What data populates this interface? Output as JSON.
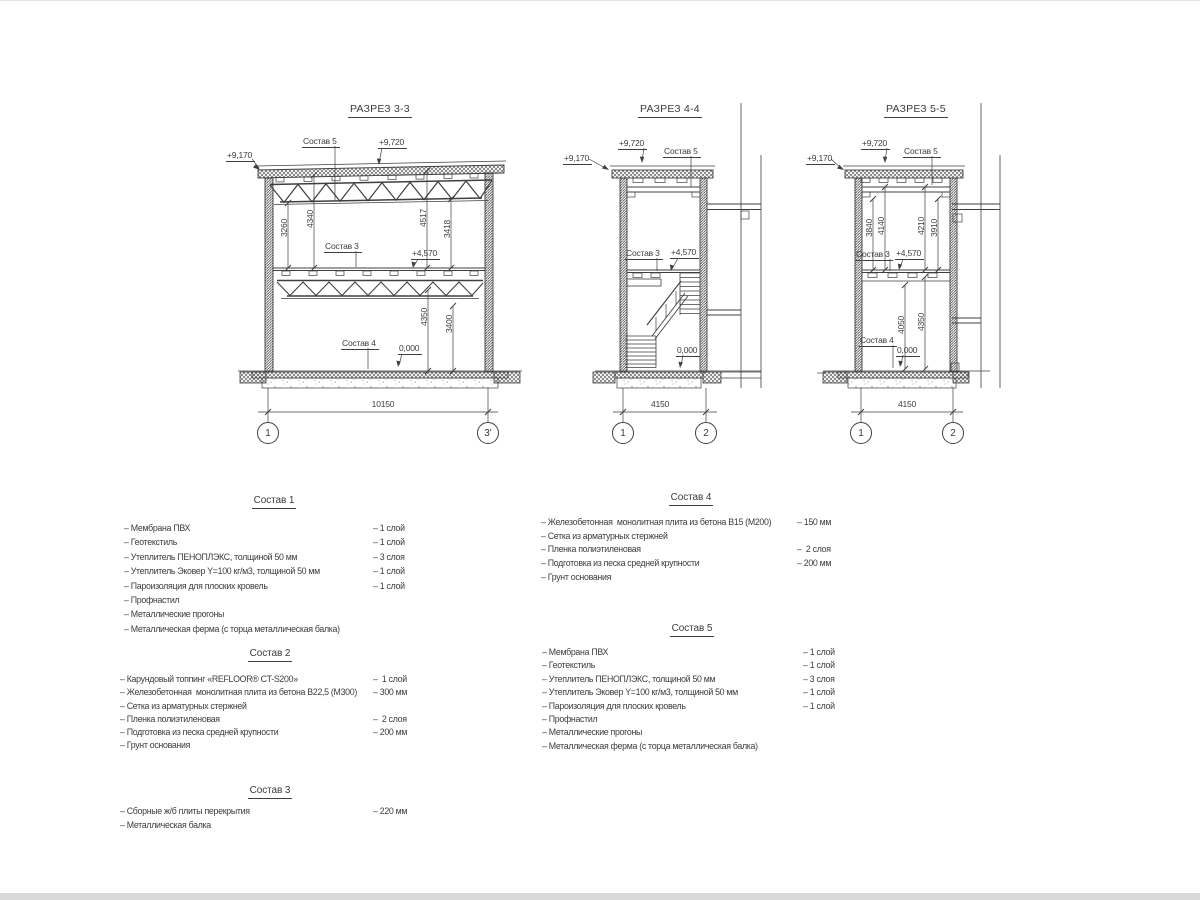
{
  "page": {
    "background": "#ffffff",
    "edge_bar_color": "#d9d9d9",
    "line_color": "#3f3f3f"
  },
  "sections": [
    {
      "title": "РАЗРЕЗ 3-3",
      "labels": {
        "roof": "Состав 5",
        "floor": "Состав 3",
        "ground": "Состав 4"
      },
      "levels": {
        "roof_edge": "+9,170",
        "roof_top": "+9,720",
        "mid": "+4,570",
        "zero": "0,000"
      },
      "dims_upper": [
        "3260",
        "4340",
        "4517",
        "3418"
      ],
      "dims_lower": [
        "4350",
        "3400"
      ],
      "width_dim": "10150",
      "axis_left": "1",
      "axis_right": "3'"
    },
    {
      "title": "РАЗРЕЗ 4-4",
      "labels": {
        "roof": "Состав 5",
        "floor": "Состав 3"
      },
      "levels": {
        "roof_edge": "+9,170",
        "roof_top": "+9,720",
        "mid": "+4,570",
        "zero": "0,000"
      },
      "width_dim": "4150",
      "axis_left": "1",
      "axis_right": "2"
    },
    {
      "title": "РАЗРЕЗ 5-5",
      "labels": {
        "roof": "Состав 5",
        "floor": "Состав 3",
        "ground": "Состав 4"
      },
      "levels": {
        "roof_edge": "+9,170",
        "roof_top": "+9,720",
        "mid": "+4,570",
        "zero": "0,000"
      },
      "dims_upper": [
        "3840",
        "4140",
        "4210",
        "3910"
      ],
      "dims_lower": [
        "4050",
        "4350"
      ],
      "width_dim": "4150",
      "axis_left": "1",
      "axis_right": "2"
    }
  ],
  "lists": [
    {
      "title": "Состав 1",
      "items": [
        {
          "name": "– Мембрана ПВХ",
          "qty": "– 1 слой"
        },
        {
          "name": "– Геотекстиль",
          "qty": "– 1 слой"
        },
        {
          "name": "– Утеплитель ПЕНОПЛЭКС, толщиной 50 мм",
          "qty": "– 3 слоя"
        },
        {
          "name": "– Утеплитель Эковер Y=100 кг/м3, толщиной 50 мм",
          "qty": "– 1 слой"
        },
        {
          "name": "– Пароизоляция для плоских кровель",
          "qty": "– 1 слой"
        },
        {
          "name": "– Профнастил",
          "qty": ""
        },
        {
          "name": "– Металлические прогоны",
          "qty": ""
        },
        {
          "name": "– Металлическая ферма (с торца металлическая балка)",
          "qty": ""
        }
      ]
    },
    {
      "title": "Состав 2",
      "items": [
        {
          "name": "– Карундовый топпинг «REFLOOR® CT-S200»",
          "qty": "–  1 слой"
        },
        {
          "name": "– Железобетонная  монолитная плита из бетона В22,5 (М300)",
          "qty": "– 300 мм"
        },
        {
          "name": "– Сетка из арматурных стержней",
          "qty": ""
        },
        {
          "name": "– Пленка полиэтиленовая",
          "qty": "–  2 слоя"
        },
        {
          "name": "– Подготовка из песка средней крупности",
          "qty": "– 200 мм"
        },
        {
          "name": "– Грунт основания",
          "qty": ""
        }
      ]
    },
    {
      "title": "Состав 3",
      "items": [
        {
          "name": "– Сборные ж/б плиты перекрытия",
          "qty": "– 220 мм"
        },
        {
          "name": "– Металлическая балка",
          "qty": ""
        }
      ]
    },
    {
      "title": "Состав 4",
      "items": [
        {
          "name": "– Железобетонная  монолитная плита из бетона В15 (М200)",
          "qty": "– 150 мм"
        },
        {
          "name": "– Сетка из арматурных стержней",
          "qty": ""
        },
        {
          "name": "– Пленка полиэтиленовая",
          "qty": "–  2 слоя"
        },
        {
          "name": "– Подготовка из песка средней крупности",
          "qty": "– 200 мм"
        },
        {
          "name": "– Грунт основания",
          "qty": ""
        }
      ]
    },
    {
      "title": "Состав 5",
      "items": [
        {
          "name": "– Мембрана ПВХ",
          "qty": "– 1 слой"
        },
        {
          "name": "– Геотекстиль",
          "qty": "– 1 слой"
        },
        {
          "name": "– Утеплитель ПЕНОПЛЭКС, толщиной 50 мм",
          "qty": "– 3 слоя"
        },
        {
          "name": "– Утеплитель Эковер Y=100 кг/м3, толщиной 50 мм",
          "qty": "– 1 слой"
        },
        {
          "name": "– Пароизоляция для плоских кровель",
          "qty": "– 1 слой"
        },
        {
          "name": "– Профнастил",
          "qty": ""
        },
        {
          "name": "– Металлические прогоны",
          "qty": ""
        },
        {
          "name": "– Металлическая ферма (с торца металлическая балка)",
          "qty": ""
        }
      ]
    }
  ]
}
